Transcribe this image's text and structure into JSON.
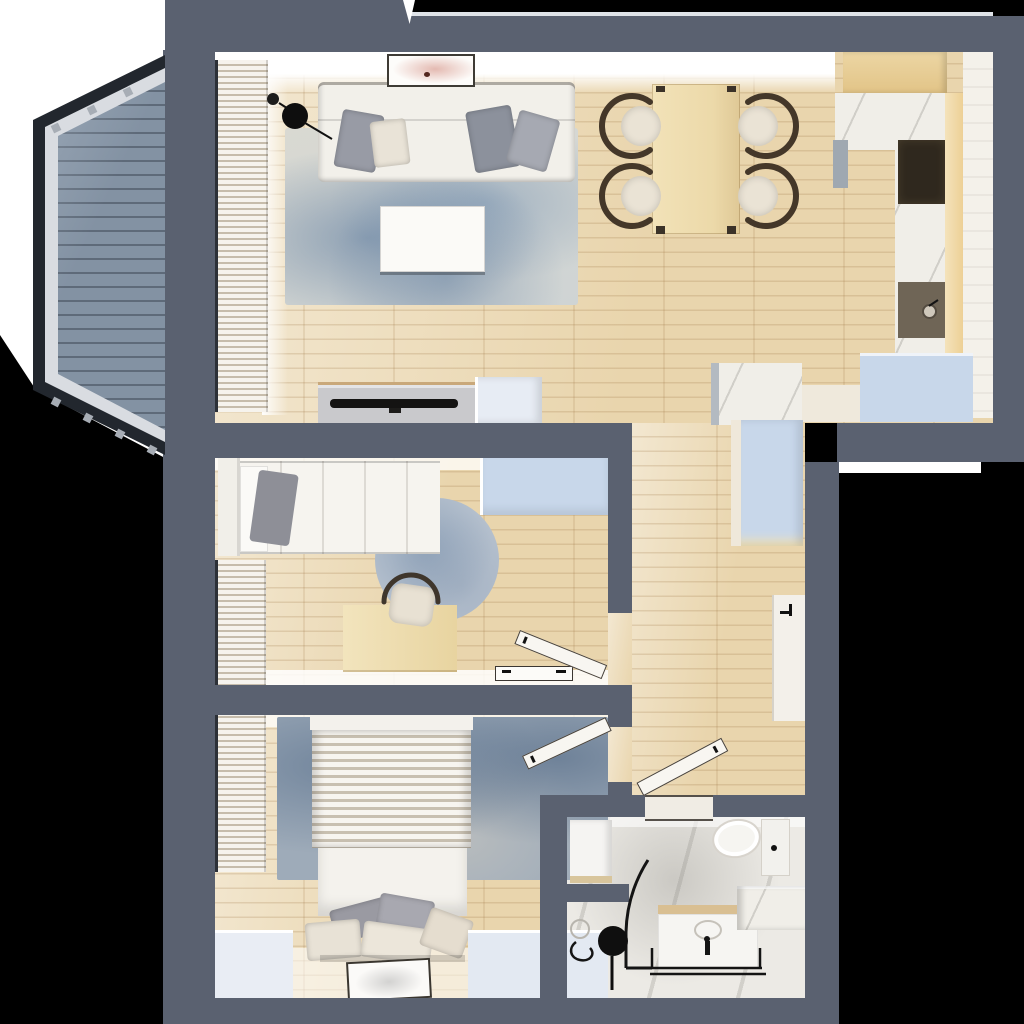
{
  "title": "apartment-floor-plan-3d-top-view",
  "scene": {
    "type": "rendered floor plan, top-down view, no visible text",
    "regions": [
      "balcony",
      "living-room",
      "dining-area",
      "kitchen",
      "hallway",
      "entry",
      "bedroom-office",
      "bedroom-master",
      "bathroom"
    ],
    "furniture": [
      "corner-sofa",
      "throw-pillows",
      "floor-lamp",
      "area-rug",
      "coffee-table",
      "tv-console",
      "tv",
      "wall-art",
      "dining-table",
      "dining-chairs",
      "kitchen-upper-cabinet",
      "kitchen-counter",
      "cooktop",
      "kitchen-sink",
      "tall-cabinet",
      "entry-closets",
      "hall-wardrobe",
      "wall-cabinet",
      "single-bed",
      "wardrobe",
      "desk",
      "desk-chair",
      "round-rug",
      "double-bed",
      "bed-pillows",
      "bedside-benches",
      "floor-tray",
      "window-blinds",
      "washing-machine",
      "shower",
      "shower-stool",
      "sink-vanity",
      "toilet",
      "entrance-door-mat",
      "interior-doors",
      "balcony-deck",
      "balcony-railing"
    ]
  },
  "palette": {
    "wall": "#5a6170",
    "outside_light": "#ffffff",
    "wood": "#e9d5ad",
    "wood_light": "#f3e8d2",
    "deck": "#8392a3",
    "deck_line": "#5e6a79",
    "railing": "#22272e",
    "frame": "#d9dce1",
    "rug_base": "#cfd4d4",
    "rug_bed": "#9eabb9",
    "rug_round": "#b7c2cf",
    "closet_blue": "#c8d7ea",
    "cube": "#e7ecf4",
    "cream": "#efe9dc",
    "marble": "#f0eee8",
    "glow": "#edd096",
    "cooktop": "#2f281e",
    "sink": "#6f6556",
    "sofa": "#f2f0ea",
    "pillow_gray": "#989ba5",
    "pillow_cream": "#e9e3d7",
    "wood_furn": "#ecd9a9",
    "chair_dark": "#443729",
    "tv": "#141312",
    "console": "#c9c9cc",
    "bath_floor": "#eceae5",
    "fixture": "#f6f5f2",
    "black": "#141414",
    "blinds_a": "#f6f3ed",
    "blinds_b": "#c6bcab",
    "leaf": "#f8f6f1",
    "entry": "#ccd2db"
  }
}
